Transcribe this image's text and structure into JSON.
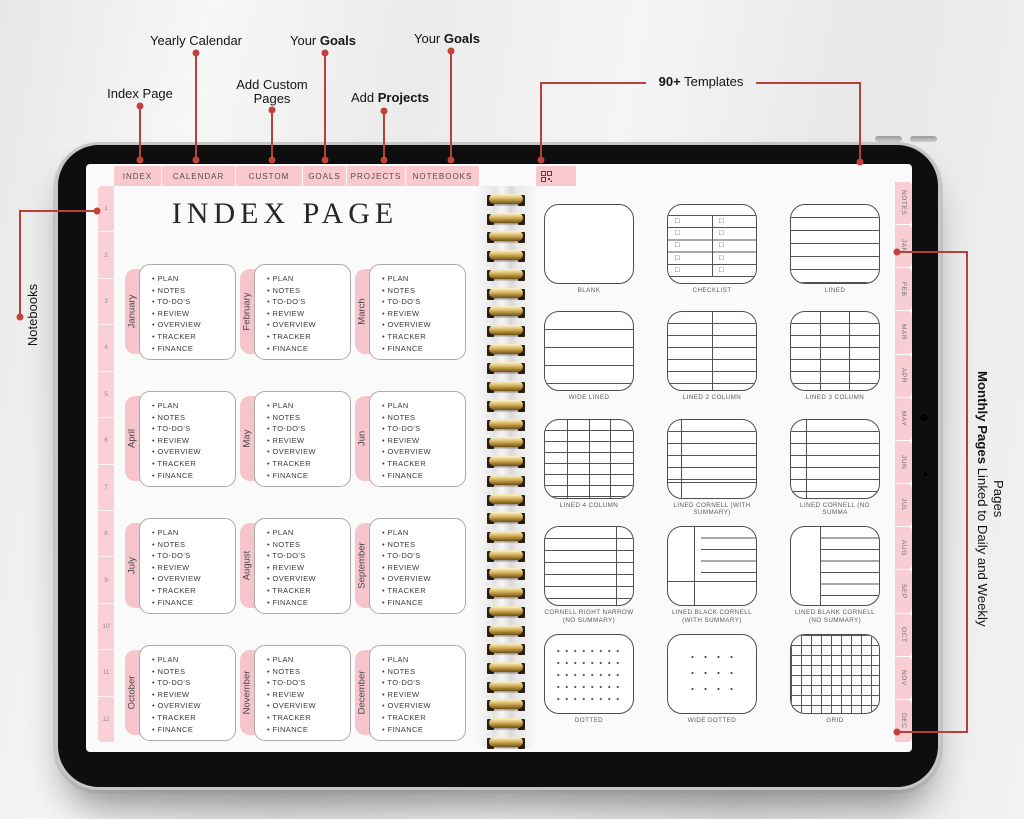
{
  "annotations": {
    "index_page": "Index Page",
    "yearly_calendar": "Yearly Calendar",
    "add_custom_pages": "Add Custom Pages",
    "your_goals_top": {
      "pre": "Your ",
      "bold": "Goals"
    },
    "add_projects": {
      "pre": "Add ",
      "bold": "Projects"
    },
    "your_goals_right": {
      "pre": "Your ",
      "bold": "Goals"
    },
    "templates_count": {
      "bold": "90+",
      "post": " Templates"
    },
    "notebooks": "Notebooks",
    "monthly_pages": {
      "bold": "Monthly Pages",
      "post": " Linked to Daily and Weekly Pages"
    }
  },
  "tablet": {
    "tab_bar": {
      "tabs": [
        "INDEX",
        "CALENDAR",
        "CUSTOM",
        "GOALS",
        "PROJECTS",
        "NOTEBOOKS"
      ],
      "icon_tab_icon": "template-grid-icon"
    },
    "left_strip_numbers": [
      "1",
      "2",
      "3",
      "4",
      "5",
      "6",
      "7",
      "8",
      "9",
      "10",
      "11",
      "12"
    ],
    "right_strip_tabs": [
      "NOTES",
      "JAN",
      "FEB",
      "MAR",
      "APR",
      "MAY",
      "JUN",
      "JUL",
      "AUG",
      "SEP",
      "OCT",
      "NOV",
      "DEC"
    ],
    "left_page": {
      "title": "INDEX PAGE",
      "months": [
        {
          "name": "January",
          "items": [
            "PLAN",
            "NOTES",
            "TO-DO'S",
            "REVIEW",
            "OVERVIEW",
            "TRACKER",
            "FINANCE"
          ]
        },
        {
          "name": "February",
          "items": [
            "PLAN",
            "NOTES",
            "TO-DO'S",
            "REVIEW",
            "OVERVIEW",
            "TRACKER",
            "FINANCE"
          ]
        },
        {
          "name": "March",
          "items": [
            "PLAN",
            "NOTES",
            "TO-DO'S",
            "REVIEW",
            "OVERVIEW",
            "TRACKER",
            "FINANCE"
          ]
        },
        {
          "name": "April",
          "items": [
            "PLAN",
            "NOTES",
            "TO-DO'S",
            "REVIEW",
            "OVERVIEW",
            "TRACKER",
            "FINANCE"
          ]
        },
        {
          "name": "May",
          "items": [
            "PLAN",
            "NOTES",
            "TO-DO'S",
            "REVIEW",
            "OVERVIEW",
            "TRACKER",
            "FINANCE"
          ]
        },
        {
          "name": "Jun",
          "items": [
            "PLAN",
            "NOTES",
            "TO-DO'S",
            "REVIEW",
            "OVERVIEW",
            "TRACKER",
            "FINANCE"
          ]
        },
        {
          "name": "July",
          "items": [
            "PLAN",
            "NOTES",
            "TO-DO'S",
            "REVIEW",
            "OVERVIEW",
            "TRACKER",
            "FINANCE"
          ]
        },
        {
          "name": "August",
          "items": [
            "PLAN",
            "NOTES",
            "TO-DO'S",
            "REVIEW",
            "OVERVIEW",
            "TRACKER",
            "FINANCE"
          ]
        },
        {
          "name": "September",
          "items": [
            "PLAN",
            "NOTES",
            "TO-DO'S",
            "REVIEW",
            "OVERVIEW",
            "TRACKER",
            "FINANCE"
          ]
        },
        {
          "name": "October",
          "items": [
            "PLAN",
            "NOTES",
            "TO-DO'S",
            "REVIEW",
            "OVERVIEW",
            "TRACKER",
            "FINANCE"
          ]
        },
        {
          "name": "November",
          "items": [
            "PLAN",
            "NOTES",
            "TO-DO'S",
            "REVIEW",
            "OVERVIEW",
            "TRACKER",
            "FINANCE"
          ]
        },
        {
          "name": "December",
          "items": [
            "PLAN",
            "NOTES",
            "TO-DO'S",
            "REVIEW",
            "OVERVIEW",
            "TRACKER",
            "FINANCE"
          ]
        }
      ]
    },
    "right_page": {
      "templates": [
        {
          "label": "BLANK",
          "pattern": "blank"
        },
        {
          "label": "CHECKLIST",
          "pattern": "checklist"
        },
        {
          "label": "LINED",
          "pattern": "lined"
        },
        {
          "label": "WIDE LINED",
          "pattern": "wide-lined"
        },
        {
          "label": "LINED 2 COLUMN",
          "pattern": "col2"
        },
        {
          "label": "LINED 3 COLUMN",
          "pattern": "col3"
        },
        {
          "label": "LINED 4 COLUMN",
          "pattern": "col4"
        },
        {
          "label": "LINED CORNELL (WITH SUMMARY)",
          "pattern": "cornell-sum"
        },
        {
          "label": "LINED CORNELL (NO SUMMA",
          "pattern": "cornell-nosum"
        },
        {
          "label": "CORNELL RIGHT NARROW (NO SUMMARY)",
          "pattern": "cornell-right"
        },
        {
          "label": "LINED BLACK CORNELL (WITH SUMMARY)",
          "pattern": "black-cornell"
        },
        {
          "label": "LINED BLANK CORNELL (NO SUMMARY)",
          "pattern": "blank-cornell"
        },
        {
          "label": "DOTTED",
          "pattern": "dotted"
        },
        {
          "label": "WIDE DOTTED",
          "pattern": "wide-dotted"
        },
        {
          "label": "GRID",
          "pattern": "grid"
        }
      ]
    }
  }
}
